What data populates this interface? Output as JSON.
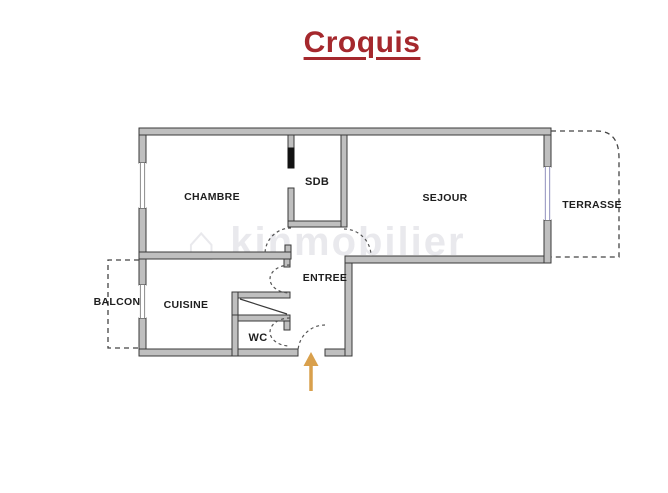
{
  "title": {
    "text": "Croquis",
    "color": "#A5282D",
    "underlined": true
  },
  "watermark": {
    "icon": "house-icon",
    "text": "kinmobilier"
  },
  "rooms": {
    "chambre": "CHAMBRE",
    "sdb": "SDB",
    "sejour": "SEJOUR",
    "terrasse": "TERRASSE",
    "balcon": "BALCON",
    "cuisine": "CUISINE",
    "entree": "ENTREE",
    "wc": "WC"
  },
  "plan": {
    "outdoor_dashed_areas": [
      "TERRASSE",
      "BALCON"
    ],
    "entrance_marker": "orange-up-arrow",
    "door_swings": [
      "chambre",
      "cuisine",
      "wc",
      "sejour",
      "entrance"
    ],
    "windows": [
      "chambre-left-wall",
      "cuisine-left-wall",
      "sejour-right-wall"
    ]
  },
  "colors": {
    "title_red": "#A5282D",
    "wall_fill": "#BFBFBF",
    "wall_stroke": "#3A3A3A",
    "room_label": "#1E1E1E",
    "door_swing_dash": "#555555",
    "window_line": "#8A8A8A",
    "window_line_blue": "#A2A2C8",
    "door_leaf_black": "#121212",
    "entrance_arrow": "#D9A04C",
    "watermark_gray": "#B9B9C4"
  }
}
